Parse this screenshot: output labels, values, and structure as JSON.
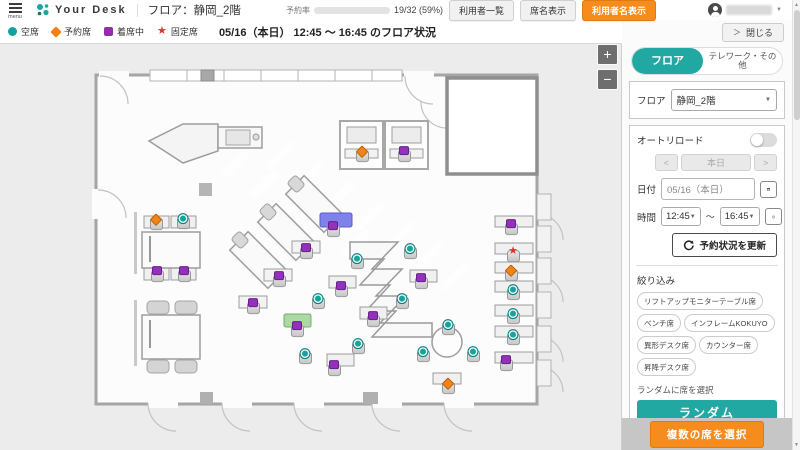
{
  "header": {
    "menu_label": "menu",
    "brand": "Your Desk",
    "floor_title": "フロア：静岡_2階",
    "occupancy": {
      "label": "予約率",
      "value_text": "19/32 (59%)",
      "percent": 59
    },
    "buttons": {
      "user_list": "利用者一覧",
      "seat_names": "席名表示",
      "user_names": "利用者名表示"
    }
  },
  "legend": {
    "items": [
      {
        "label": "空席",
        "shape": "circle",
        "color": "#12a3a0"
      },
      {
        "label": "予約席",
        "shape": "diamond",
        "color": "#f0820f"
      },
      {
        "label": "着席中",
        "shape": "square",
        "color": "#9c27b0"
      },
      {
        "label": "固定席",
        "shape": "star",
        "color": "#e0312e"
      }
    ],
    "status_text": "05/16（本日） 12:45 ～ 16:45 のフロア状況"
  },
  "map": {
    "zoom_in": "+",
    "zoom_out": "−",
    "seats": [
      {
        "x": 183,
        "y": 178,
        "status": "available"
      },
      {
        "x": 357,
        "y": 218,
        "status": "available"
      },
      {
        "x": 410,
        "y": 208,
        "status": "available"
      },
      {
        "x": 402,
        "y": 258,
        "status": "available"
      },
      {
        "x": 318,
        "y": 258,
        "status": "available"
      },
      {
        "x": 358,
        "y": 303,
        "status": "available"
      },
      {
        "x": 305,
        "y": 313,
        "status": "available"
      },
      {
        "x": 448,
        "y": 284,
        "status": "available"
      },
      {
        "x": 423,
        "y": 311,
        "status": "available"
      },
      {
        "x": 473,
        "y": 311,
        "status": "available"
      },
      {
        "x": 513,
        "y": 249,
        "status": "available"
      },
      {
        "x": 513,
        "y": 273,
        "status": "available"
      },
      {
        "x": 513,
        "y": 294,
        "status": "available"
      },
      {
        "x": 157,
        "y": 231,
        "status": "occupied"
      },
      {
        "x": 184,
        "y": 231,
        "status": "occupied"
      },
      {
        "x": 404,
        "y": 111,
        "status": "occupied"
      },
      {
        "x": 333,
        "y": 186,
        "status": "occupied"
      },
      {
        "x": 306,
        "y": 208,
        "status": "occupied"
      },
      {
        "x": 279,
        "y": 236,
        "status": "occupied"
      },
      {
        "x": 253,
        "y": 263,
        "status": "occupied"
      },
      {
        "x": 341,
        "y": 246,
        "status": "occupied"
      },
      {
        "x": 421,
        "y": 238,
        "status": "occupied"
      },
      {
        "x": 373,
        "y": 276,
        "status": "occupied"
      },
      {
        "x": 297,
        "y": 286,
        "status": "occupied"
      },
      {
        "x": 334,
        "y": 325,
        "status": "occupied"
      },
      {
        "x": 506,
        "y": 320,
        "status": "occupied"
      },
      {
        "x": 511,
        "y": 184,
        "status": "occupied"
      },
      {
        "x": 156,
        "y": 179,
        "status": "reserved"
      },
      {
        "x": 362,
        "y": 111,
        "status": "reserved"
      },
      {
        "x": 448,
        "y": 343,
        "status": "reserved"
      },
      {
        "x": 511,
        "y": 230,
        "status": "reserved"
      },
      {
        "x": 513,
        "y": 211,
        "status": "fixed"
      }
    ]
  },
  "sidebar": {
    "close_label": "閉じる",
    "tabs": [
      {
        "label": "フロア",
        "active": true
      },
      {
        "label": "テレワーク・その他",
        "active": false
      }
    ],
    "floor_select": {
      "label": "フロア",
      "value": "静岡_2階"
    },
    "autoreload_label": "オートリロード",
    "nav": {
      "prev": "<",
      "today": "本日",
      "next": ">"
    },
    "date": {
      "label": "日付",
      "value": "05/16（本日）"
    },
    "time": {
      "label": "時間",
      "start": "12:45",
      "separator": "～",
      "end": "16:45"
    },
    "refresh_button": "予約状況を更新",
    "filter": {
      "label": "絞り込み",
      "chips": [
        "リフトアップモニターテーブル席",
        "ベンチ席",
        "インフレームKOKUYO",
        "異形デスク席",
        "カウンター席",
        "昇降デスク席"
      ]
    },
    "random": {
      "label": "ランダムに席を選択",
      "button": "ランダム"
    },
    "multi_select_button": "複数の席を選択"
  },
  "icons": {
    "caret_down": "▼",
    "chevron_right": "＞",
    "star": "★",
    "scroll_up": "▲",
    "scroll_down": "▼"
  },
  "colors": {
    "accent_teal": "#17a89f",
    "accent_orange": "#f68b1e"
  }
}
